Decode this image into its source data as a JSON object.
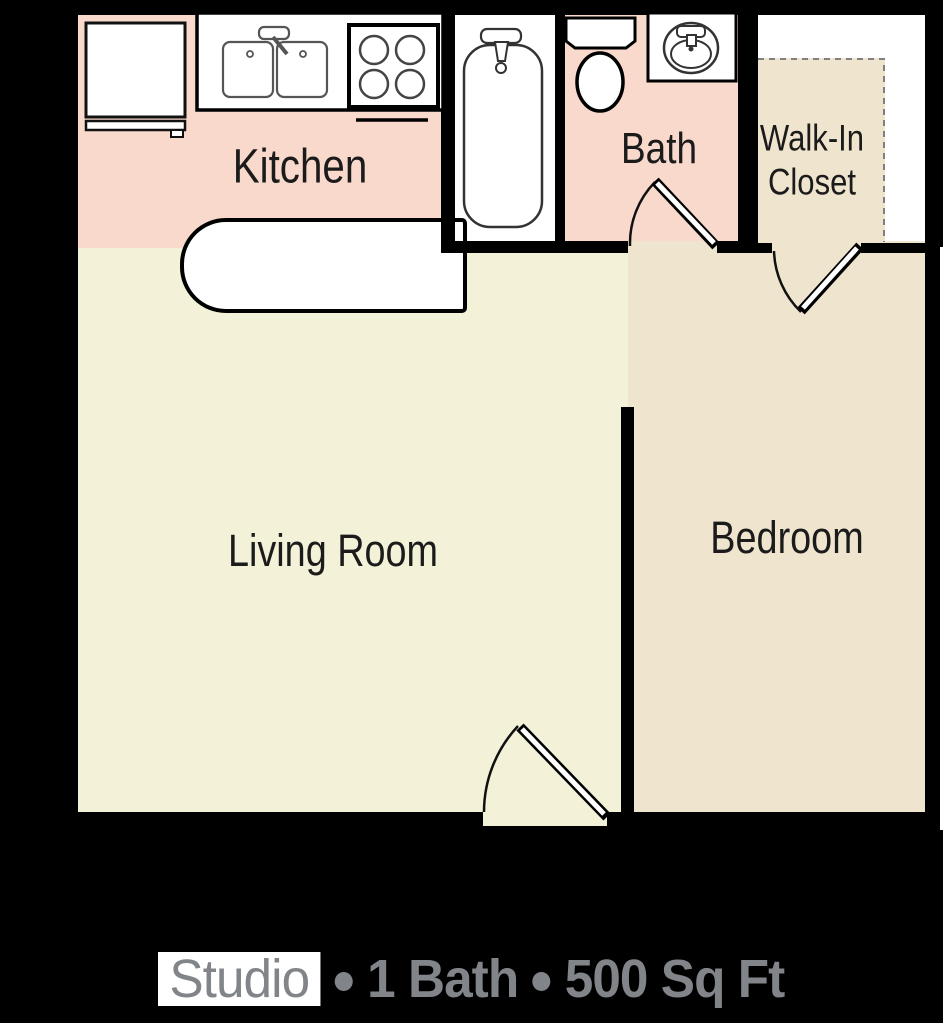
{
  "floor_plan": {
    "rooms": {
      "kitchen": {
        "label": "Kitchen"
      },
      "bath": {
        "label": "Bath"
      },
      "walk_in_closet": {
        "label_line1": "Walk-In",
        "label_line2": "Closet"
      },
      "living_room": {
        "label": "Living Room"
      },
      "bedroom": {
        "label": "Bedroom"
      }
    },
    "fixtures": [
      "refrigerator",
      "refrigerator-shelf",
      "kitchen-counter",
      "double-sink",
      "kitchen-faucet",
      "stove-four-burner",
      "oven-handle",
      "bathtub",
      "tub-faucet",
      "tub-drain",
      "toilet-tank",
      "toilet-bowl",
      "bathroom-vanity",
      "bathroom-sink-basin",
      "bathroom-sink-faucet",
      "closet-carpet-dashed-outline"
    ],
    "doors": [
      "bath-door",
      "closet-door",
      "entry-door"
    ]
  },
  "caption": {
    "unit_type": "Studio",
    "separator": "•",
    "bath_count": "1 Bath",
    "area": "500 Sq Ft"
  },
  "colors": {
    "background": "#000000",
    "kitchen_bath_floor": "#f9d9cc",
    "living_floor": "#f3f2d8",
    "bedroom_closet_floor": "#efe4ce",
    "wall": "#000000",
    "room_label_text": "#1b1b1b",
    "caption_text": "#818488",
    "fixture_outline": "#333333"
  }
}
